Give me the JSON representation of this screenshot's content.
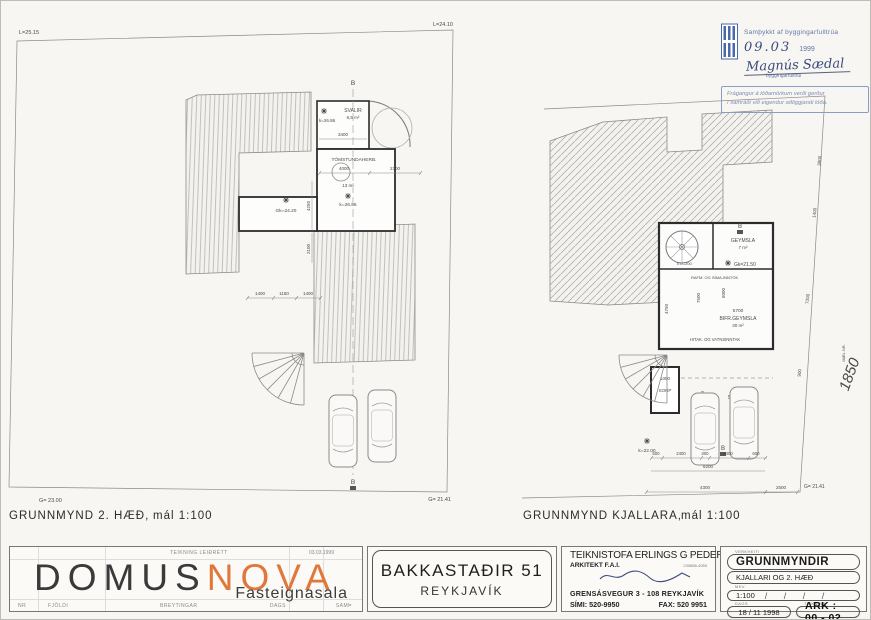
{
  "stamp": {
    "approved": "Samþykkt af byggingarfulltrúa",
    "date_hand": "09.03",
    "year": "1999",
    "signature": "Magnús Sædal",
    "signer_title": "byggingarfulltrúi",
    "note1": "Frágangur á lóðamörkum verði gerður",
    "note2": "í samráði við eigendur aðliggjandi lóða."
  },
  "lp": {
    "title": "GRUNNMYND  2. HÆÐ,",
    "scale": "mál 1:100",
    "corner_tl": "L=25.15",
    "corner_tr": "L=24.10",
    "corner_bl": "G= 23.00",
    "corner_br": "G= 21.41",
    "section": "B",
    "level_top": "k=26.86",
    "svalir": "SVALIR",
    "svalir_area": "6,5 m²",
    "room": "TÓMSTUNDAHERB.",
    "room_area": "13 m²",
    "level_room": "k=26.86",
    "level_hall": "Gk=24.20",
    "dim_3400": "3400",
    "dim_4000": "4000",
    "dim_2300": "2300",
    "dim_1400a": "1400",
    "dim_1150": "1150",
    "dim_1400b": "1400",
    "dim_4250": "4250",
    "dim_2100": "2100"
  },
  "rp": {
    "title": "GRUNNMYND  KJALLARA,",
    "scale": "mál 1:100",
    "corner_br": "G= 21.41",
    "section": "B",
    "geymsla": "GEYMSLA",
    "geymsla_area": "7 m²",
    "level_gk": "Gk=21.50",
    "ei": "EI-C200",
    "rafm": "RAFM. OG SÍMA-INNTÖK",
    "dim_5700": "5700",
    "bifr": "BIFR.GEYMSLA",
    "bifr_area": "30 m²",
    "hitak": "HITAK. OG VATNSINNTAK",
    "dim_7500": "7500",
    "dim_6000": "6000",
    "dim_4750": "4750",
    "dim_1050": "1050",
    "sorp": "SORP",
    "dim_2000": "2000",
    "stett": "STÉTT",
    "level_k22": "k=22.00",
    "d500": "500",
    "d2400a": "2400",
    "d300": "300",
    "d2400b": "2400",
    "d600": "600",
    "d6200": "6200",
    "d4300": "4300",
    "d2500": "2500",
    "s3800": "3800",
    "s1400": "1400",
    "s7200": "7200",
    "s900": "900",
    "mael_label": "MÆL.NR.",
    "mael_no": "1850"
  },
  "tb": {
    "logo": {
      "rev_note": "TEIKNING LEIÐRÉTT",
      "rev_date": "03.03.1999",
      "word1": "DOMUS",
      "word2": "NOVA",
      "subtitle": "Fasteignasala",
      "col_nr": "NR",
      "col_fjoldi": "FJÖLDI",
      "col_breyt": "BREYTINGAR",
      "col_dags": "DAGS",
      "col_samth": "SAMÞ"
    },
    "address": {
      "line1": "BAKKASTAÐIR 51",
      "line2": "REYKJAVÍK"
    },
    "arch": {
      "firm": "TEIKNISTOFA ERLINGS G PEDERSEN",
      "role": "ARKITEKT  F.A.I.",
      "reg": "230858-4059",
      "street": "GRENSÁSVEGUR 3  -  108 REYKJAVÍK",
      "phone": "SÍMI:  520-9950",
      "fax": "FAX:  520 9951"
    },
    "draw": {
      "head_label": "VERKHEITI",
      "heading": "GRUNNMYNDIR",
      "sub": "KJALLARI OG 2. HÆÐ",
      "scale_label": "MKV.",
      "scale": "1:100",
      "slashes": "/    /    /    /",
      "date_label": "DAGS",
      "date": "18 / 11     1998",
      "no_label": "TEIKN.NR.",
      "number": "ARK  :  00  -  02"
    }
  },
  "colors": {
    "stamp_blue": "#5470a8",
    "logo_orange": "#e0783c",
    "ink": "#3a3a3a"
  }
}
